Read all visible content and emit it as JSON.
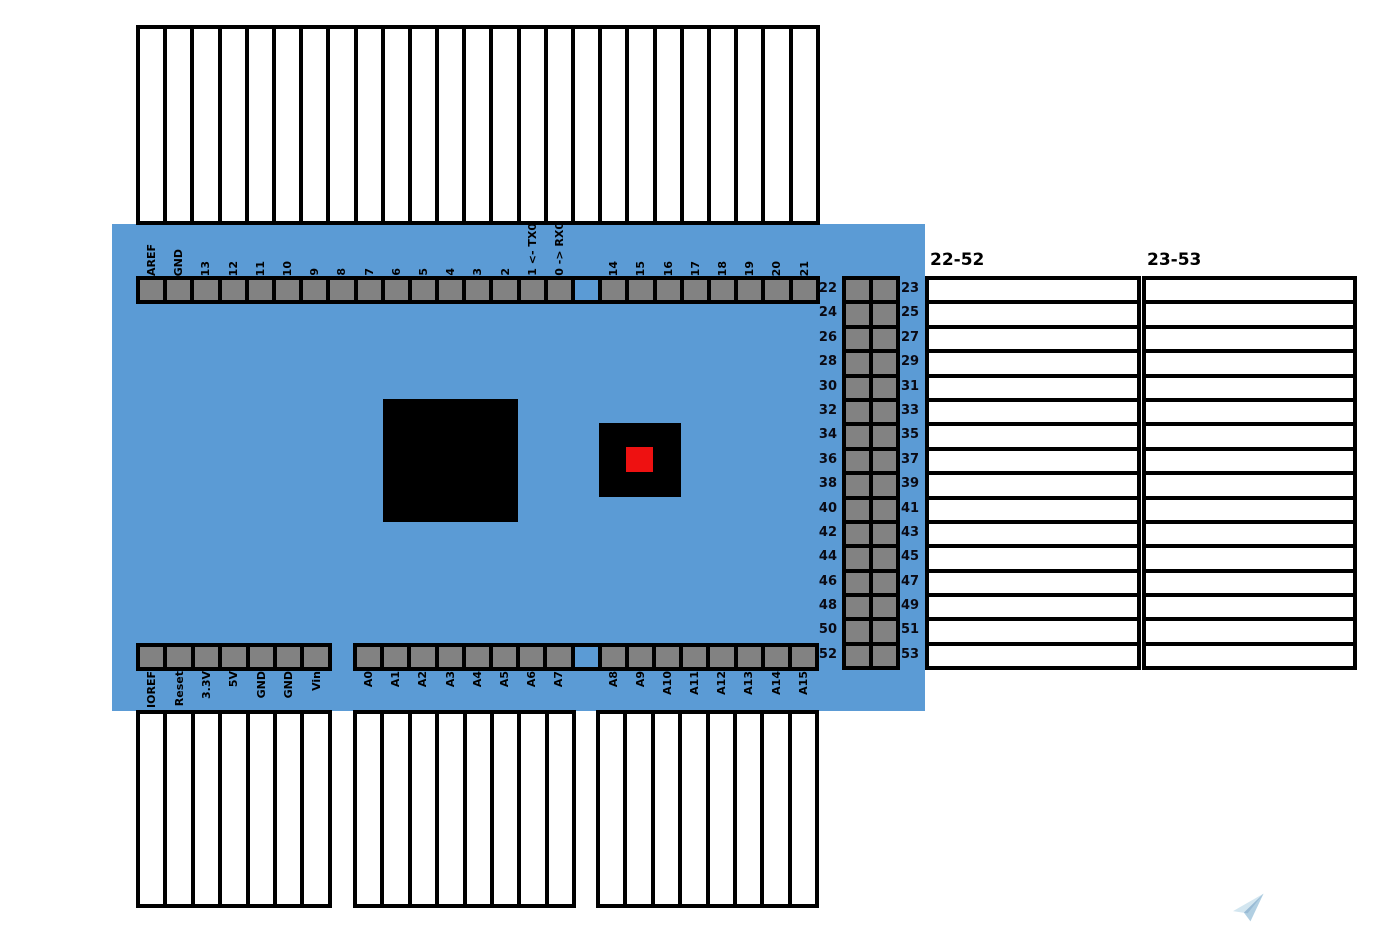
{
  "colors": {
    "board": "#5b9bd5",
    "pin": "#828282",
    "chip": "#000000",
    "led": "#ee1111",
    "plane_light": "#cfe4ef",
    "plane_mid": "#a9cadf",
    "plane_dark": "#8fb4d1"
  },
  "top_header": {
    "labels": [
      "AREF",
      "GND",
      "13",
      "12",
      "11",
      "10",
      "9",
      "8",
      "7",
      "6",
      "5",
      "4",
      "3",
      "2",
      "1 <- TX0",
      "0 -> RX0",
      "",
      "14",
      "15",
      "16",
      "17",
      "18",
      "19",
      "20",
      "21"
    ]
  },
  "power_header": {
    "labels": [
      "IOREF",
      "Reset",
      "3.3V",
      "5V",
      "GND",
      "GND",
      "Vin"
    ]
  },
  "analog_header": {
    "labels": [
      "A0",
      "A1",
      "A2",
      "A3",
      "A4",
      "A5",
      "A6",
      "A7",
      "",
      "A8",
      "A9",
      "A10",
      "A11",
      "A12",
      "A13",
      "A14",
      "A15"
    ]
  },
  "right_header": {
    "left_labels": [
      "22",
      "24",
      "26",
      "28",
      "30",
      "32",
      "34",
      "36",
      "38",
      "40",
      "42",
      "44",
      "46",
      "48",
      "50",
      "52"
    ],
    "right_labels": [
      "23",
      "25",
      "27",
      "29",
      "31",
      "33",
      "35",
      "37",
      "39",
      "41",
      "43",
      "45",
      "47",
      "49",
      "51",
      "53"
    ]
  },
  "tables": {
    "left_title": "22-52",
    "right_title": "23-53"
  }
}
